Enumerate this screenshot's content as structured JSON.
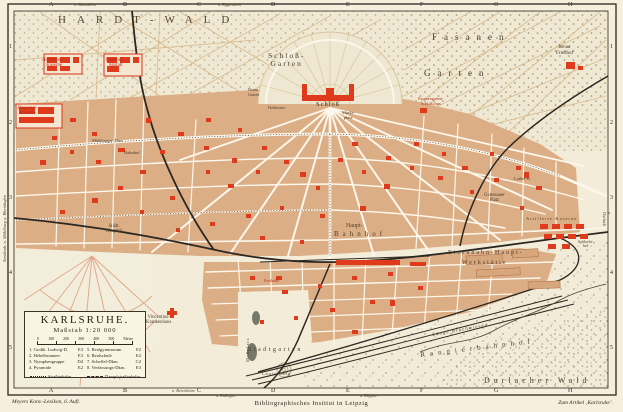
{
  "map_title": "Karlsruhe (Meyers Konversations-Lexikon city map)",
  "colors": {
    "paper": "#f6efde",
    "city_block": "#dcae86",
    "building_red": "#e03a1c",
    "forest": "#efe9d4",
    "rail": "#2c2720",
    "label_ink": "#4a3e2e"
  },
  "grid": {
    "cols": [
      "A",
      "B",
      "C",
      "D",
      "E",
      "F",
      "G",
      "H"
    ],
    "rows": [
      "1",
      "2",
      "3",
      "4",
      "5"
    ]
  },
  "labels": {
    "hardtwald": "HARDT-WALD",
    "fasanen_1": "Fasanen",
    "fasanen_2": "Garten",
    "schlossgarten": "Schloß-\nGarten",
    "botan_garten": "Botan.\nGarten",
    "hoftheater": "Hoftheater",
    "schloss": "Schloß",
    "marktplatz": "Markt-\nplatz",
    "neuer_friedhof": "Neuer\nFriedhof",
    "fasanengarten_schloesschen": "Fasanengarten-\nSchlößchen",
    "infanterie_kaserne": "Infanterie-\nKaserne",
    "kadetten_anstalt": "Kadetten-\nAnstalt",
    "dragoner_kaserne": "Dragoner-\nKaserne",
    "muehlburger_thor": "Mühlburger Thor",
    "bahnhof_west": "Bahnhof",
    "staedt_hospital": "Städt.\nHospital",
    "hauptbahnhof_1": "Haupt-",
    "hauptbahnhof_2": "Bahnhof",
    "luther_kirche": "Luther-K.",
    "gottesauer_platz": "Gottesauer\nPlatz",
    "artillerie_kaserne": "Artillerie-Kaserne",
    "schlachthof": "Schlacht-\nhof",
    "werkstaette_1": "Eisenbahn-Haupt-",
    "werkstaette_2": "Werkstätte",
    "vincentius": "Vincentius-\nKrankenhaus",
    "festhalle": "Festhalle",
    "messplatz": "Meßplatz",
    "stadtgarten": "Stadtgarten",
    "lauterberg": "Lauterberg",
    "rangierbahnhof": "Rangierbahnhof",
    "durlacher_wald": "Durlacher Wald",
    "lange_bruchwiesen": "Lange Bruchwiesen",
    "tram_left_margin": "Straßenb. n. Mühlburg u. Rheinhafen",
    "n_mannheim": "n. Mannheim",
    "n_eggenstein": "n. Eggenstein",
    "n_beiertheim": "n. Beiertheim",
    "n_ettlingen": "n. Ettlingen",
    "n_rueppurr": "n. Rüppurr",
    "n_durlach": "n. Durlach"
  },
  "title_box": {
    "title": "KARLSRUHE.",
    "scale_label": "Maßstab 1:20 000",
    "scale_ticks": [
      "0",
      "100",
      "200",
      "300",
      "400",
      "500"
    ],
    "scale_unit": "Meter",
    "legend_left": [
      {
        "name": "1. Großh. Ludwig-D.",
        "grid": "E3"
      },
      {
        "name": "2. Hebelbrunnen",
        "grid": "E3"
      },
      {
        "name": "3. Nymphengruppe",
        "grid": "D4"
      },
      {
        "name": "4. Pyramide",
        "grid": "E2"
      }
    ],
    "legend_right": [
      {
        "name": "5. Realgymnasium",
        "grid": "F2"
      },
      {
        "name": "6. Realschule",
        "grid": "E2"
      },
      {
        "name": "7. Scheffel-Dkm.",
        "grid": "C2"
      },
      {
        "name": "8. Verfassungs-Dkm.",
        "grid": "E3"
      }
    ],
    "tram_label": "Straßenbahn",
    "steam_tram_label": "Dampfstraßenbahn"
  },
  "captions": {
    "left": "Meyers Konv.-Lexikon, 6. Aufl.",
    "center": "Bibliographisches Institut in Leipzig",
    "right": "Zum Artikel ‚Karlsruhe’."
  }
}
